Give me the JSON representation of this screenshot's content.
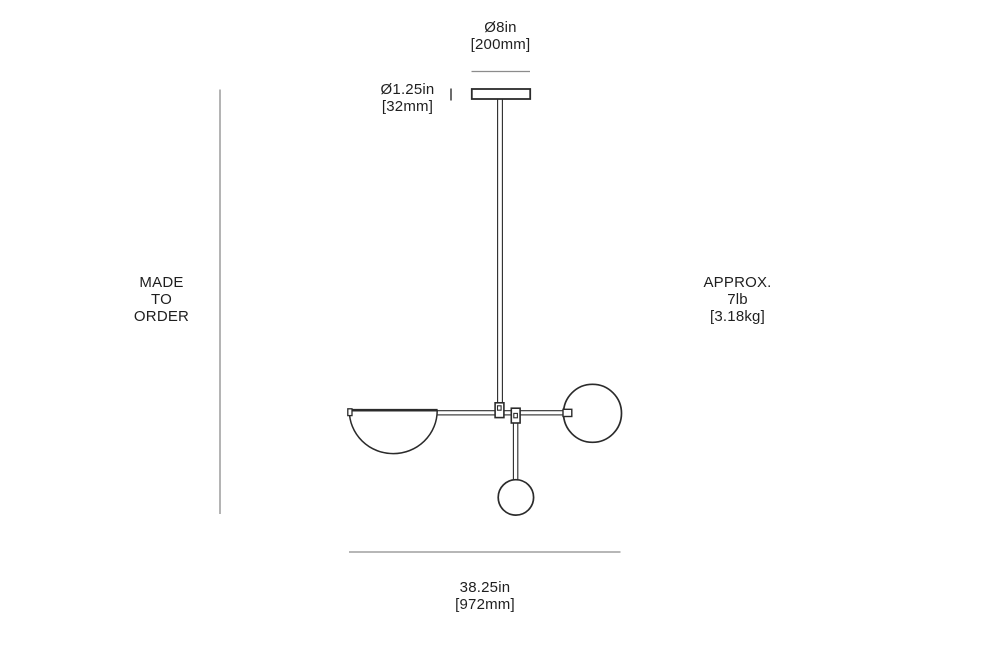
{
  "colors": {
    "background": "#ffffff",
    "dimension_line": "#8c8c8c",
    "tick_mark": "#3a3a3a",
    "drawing_stroke": "#2b2b2b",
    "text": "#1f1f1f"
  },
  "labels": {
    "canopy_diameter": {
      "inches": "Ø8in",
      "metric": "[200mm]"
    },
    "stem_diameter": {
      "inches": "Ø1.25in",
      "metric": "[32mm]"
    },
    "made_to_order": {
      "line1": "MADE",
      "line2": "TO",
      "line3": "ORDER"
    },
    "weight": {
      "line1": "APPROX.",
      "line2": "7lb",
      "line3": "[3.18kg]"
    },
    "overall_width": {
      "inches": "38.25in",
      "metric": "[972mm]"
    }
  }
}
